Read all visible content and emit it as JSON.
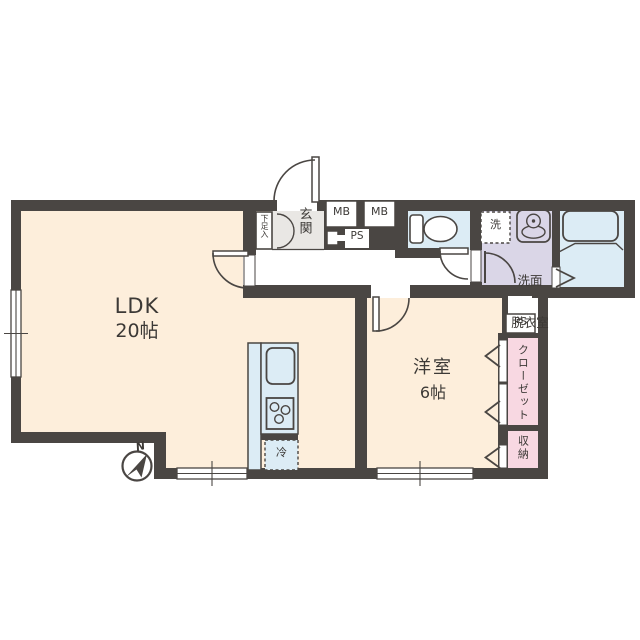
{
  "rooms": {
    "ldk": {
      "name": "LDK",
      "size": "20帖"
    },
    "western_room": {
      "name": "洋室",
      "size": "6帖"
    },
    "entrance": {
      "name": "玄関"
    },
    "shoe_cabinet": {
      "name": "下足入"
    },
    "washroom": {
      "line1": "洗面",
      "line2": "脱衣室"
    },
    "closet": {
      "name": "クローゼット"
    },
    "storage": {
      "name": "収納"
    }
  },
  "fixtures": {
    "washer": "洗",
    "fridge": "冷",
    "meter_box_1": "MB",
    "meter_box_2": "MB",
    "pipe_space_1": "PS",
    "pipe_space_2": "PS"
  },
  "compass": {
    "north": "N"
  },
  "colors": {
    "wall": "#4a4643",
    "main_floor": "#fdeedb",
    "wet_area_blue": "#dcecf5",
    "washroom_lavender": "#dad6e7",
    "closet_pink": "#f8d8e2",
    "entrance_gray": "#e9e7e4",
    "background": "#ffffff"
  }
}
